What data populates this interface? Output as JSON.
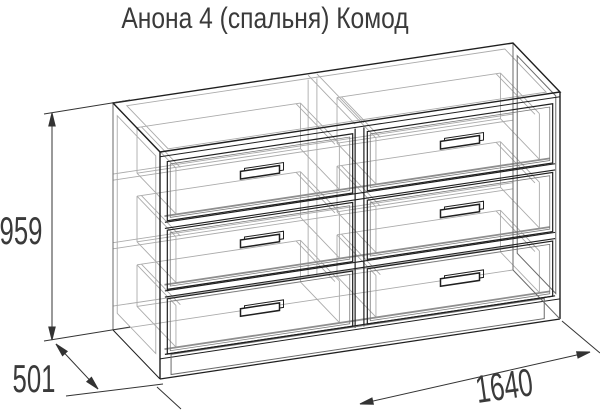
{
  "title": "Анона 4 (спальня) Комод",
  "dimensions": {
    "height_mm": "959",
    "depth_mm": "501",
    "width_mm": "1640"
  },
  "figure": {
    "kind": "wireframe technical drawing",
    "object": "chest of drawers (комод)",
    "drawer_count": 6,
    "drawer_layout": "2 columns x 3 rows",
    "has_handles": true,
    "has_plinth": true
  },
  "colors": {
    "background": "#ffffff",
    "line_dark": "#1f1f1f",
    "line_mid": "#6a6a6a",
    "line_light": "#ababab",
    "line_gray_heavy": "#8f8f8f",
    "dimension": "#333333",
    "text": "#3a3a3a"
  }
}
